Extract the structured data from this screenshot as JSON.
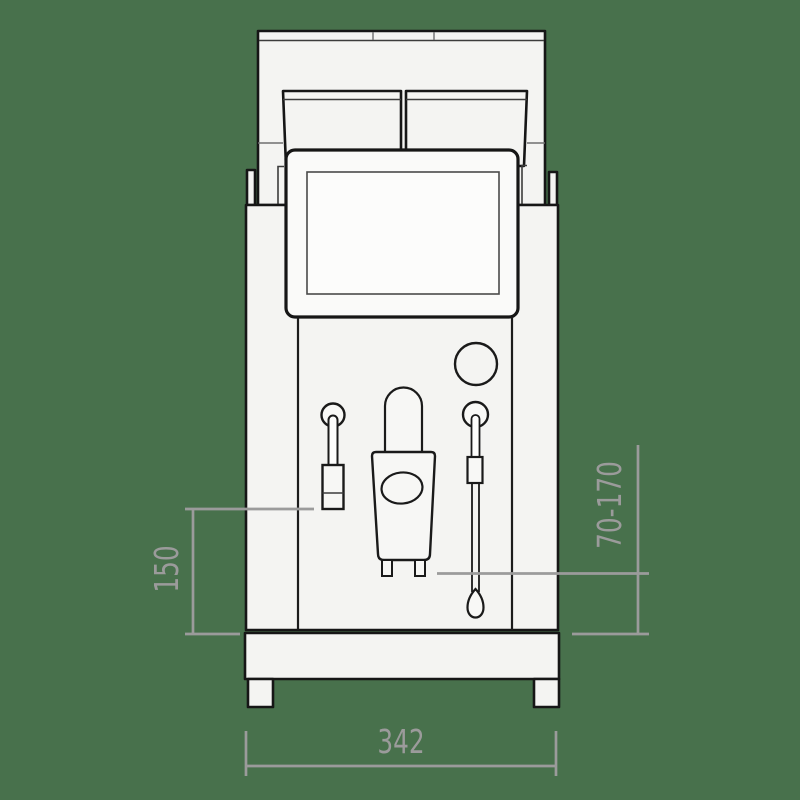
{
  "drawing": {
    "description": "Front-view technical line drawing of an espresso coffee machine with twin bean hoppers, touchscreen, coffee spout and two side wands"
  },
  "colors": {
    "background": "#48714c",
    "machine_fill": "#f4f4f2",
    "screen_fill": "#fafaf9",
    "line": "#161616",
    "dimension": "#9b9b9b"
  },
  "dimensions": {
    "left_height": {
      "label": "150",
      "orientation": "vertical"
    },
    "spout_height_range": {
      "label": "70-170",
      "orientation": "vertical"
    },
    "base_width": {
      "label": "342",
      "orientation": "horizontal"
    }
  }
}
